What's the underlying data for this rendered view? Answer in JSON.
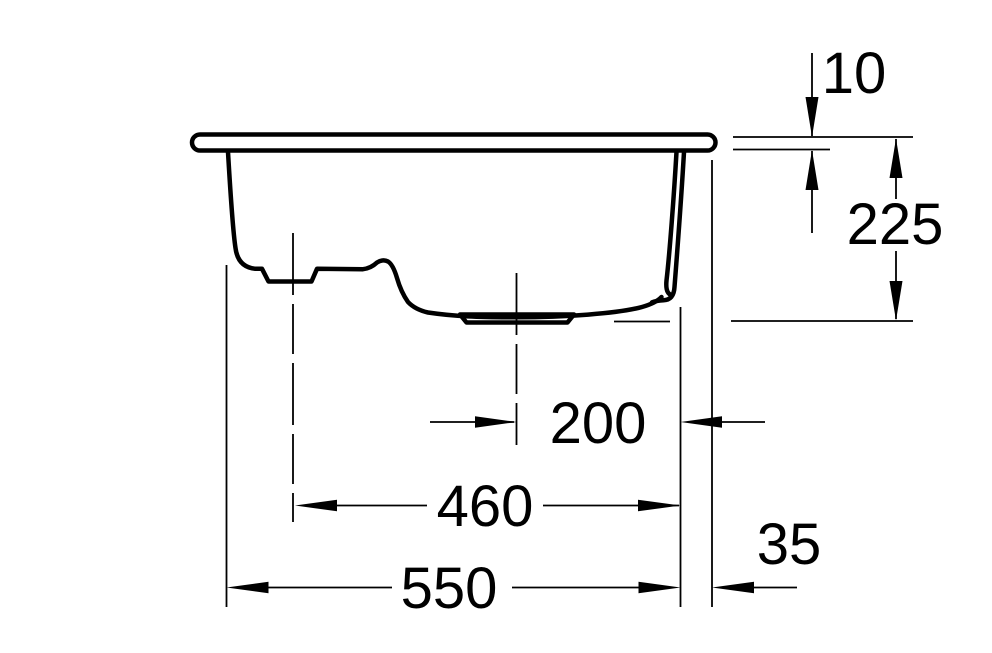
{
  "drawing": {
    "background_color": "#ffffff",
    "line_color": "#000000",
    "labels": {
      "rim_thickness": "10",
      "total_depth": "225",
      "main_drain_offset": "200",
      "left_drain_span": "460",
      "bowl_width": "550",
      "rim_overhang": "35"
    }
  }
}
